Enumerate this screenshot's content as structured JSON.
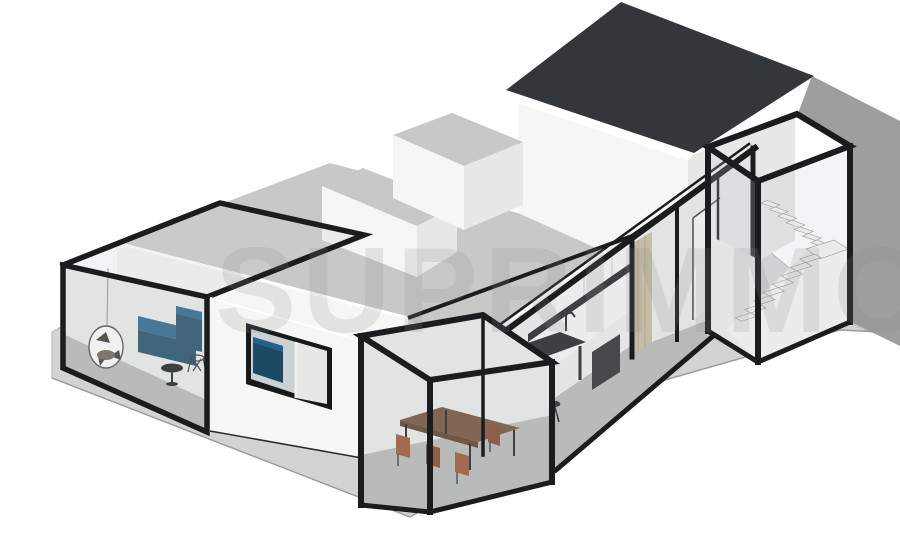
{
  "scene": {
    "type": "3d-architectural-cutaway-render",
    "description": "Axonometric 3D cutaway render of a single-storey house with glass-box rooms, front terrace, roof volumes and a two-storey tower with dark gable roof and glazed stairwell",
    "watermark": {
      "text": "SUPRIMMO"
    },
    "palette": {
      "bg": "#ffffff",
      "terrace": "#d3d3d2",
      "terrace_edge": "#b4b4b3",
      "side_wall": "#9e9e9e",
      "wall_bright": "#f6f6f5",
      "wall_mid": "#ededec",
      "wall_shade": "#e7e7e6",
      "roof_flat": "#c8c8c7",
      "roof_dark": "#34373a",
      "frame": "#1a1c1e",
      "glass": "rgba(195,203,208,0.22)",
      "glass_top": "rgba(205,212,216,0.27)",
      "interior": "#ebebea",
      "floor": "#b6b6b5",
      "sofa": "#1d4a63",
      "sofa_light": "#266088",
      "wood": "#6f4a31",
      "wood_dark": "#58381f",
      "rust": "#9c4f2d",
      "rust_dark": "#7e3f22",
      "counter": "#17191b",
      "beige": "#c4b898",
      "beige_line": "#a99d7d",
      "window_glass": "#ccd1d4",
      "vanity_blue": "#1c4a63",
      "stairs": "#f4f4f3",
      "stairs_edge": "#9a9a9a",
      "white": "#ffffff",
      "watermark_fill": "rgba(140,140,140,0.18)"
    },
    "visible_objects": [
      "living-room-glass-box",
      "navy-corner-sofa",
      "hanging-egg-chair",
      "round-side-table",
      "bathroom-window-with-blue-vanity",
      "dining-glass-extension",
      "wooden-dining-table",
      "rust-leather-chairs",
      "kitchen-with-black-countertop",
      "kitchen-island-bar",
      "black-bar-stools",
      "faucet",
      "wooden-wardrobe-panel",
      "hallway",
      "two-storey-tower",
      "dark-gable-roof",
      "glazed-stairwell",
      "switchback-stairs",
      "roof-volumes",
      "concrete-terrace",
      "neighbouring-grey-wall"
    ]
  }
}
